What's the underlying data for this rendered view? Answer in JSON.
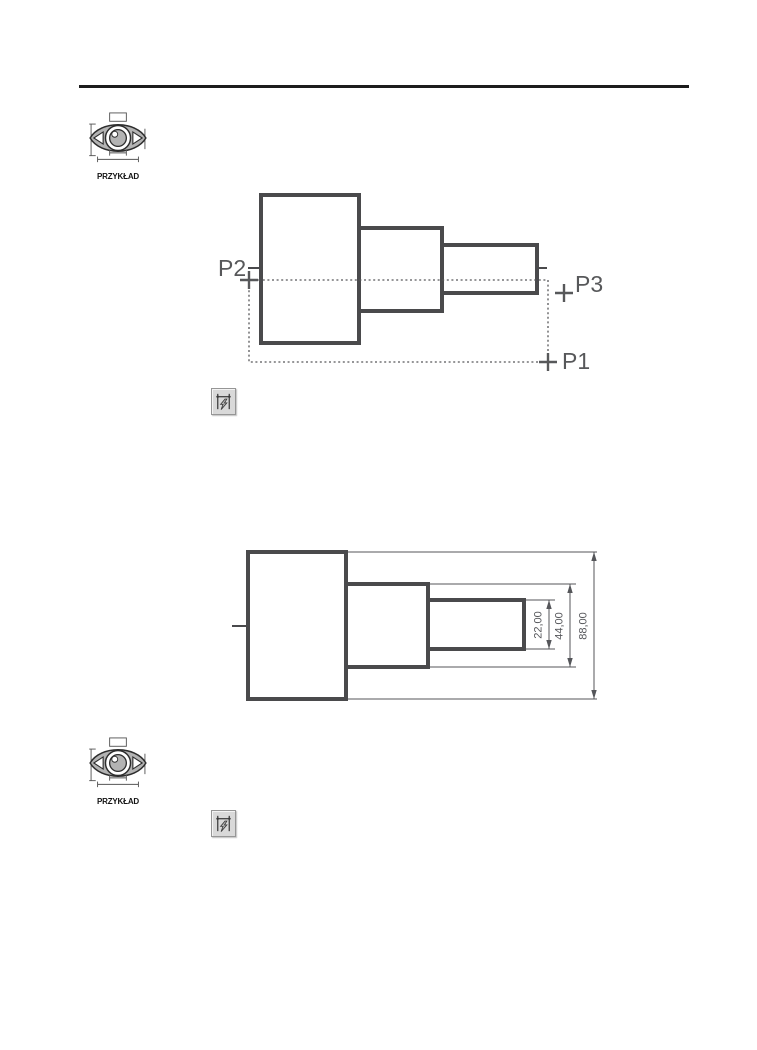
{
  "example_marker": {
    "label": "PRZYKŁAD"
  },
  "selection_drawing": {
    "p1": "P1",
    "p2": "P2",
    "p3": "P3"
  },
  "dimension_drawing": {
    "dim_22": "22,00",
    "dim_44": "44,00",
    "dim_88": "88,00"
  },
  "icons": {
    "example": "dimensioned-eye-icon",
    "toolbar": "quick-dimension-icon"
  },
  "colors": {
    "drawing_outline": "#4a4a4c",
    "annotation_gray": "#57585a",
    "header_rule": "#1c1c1c",
    "eye_fill": "#b3b3b3",
    "button_face": "#d9d9d9"
  }
}
